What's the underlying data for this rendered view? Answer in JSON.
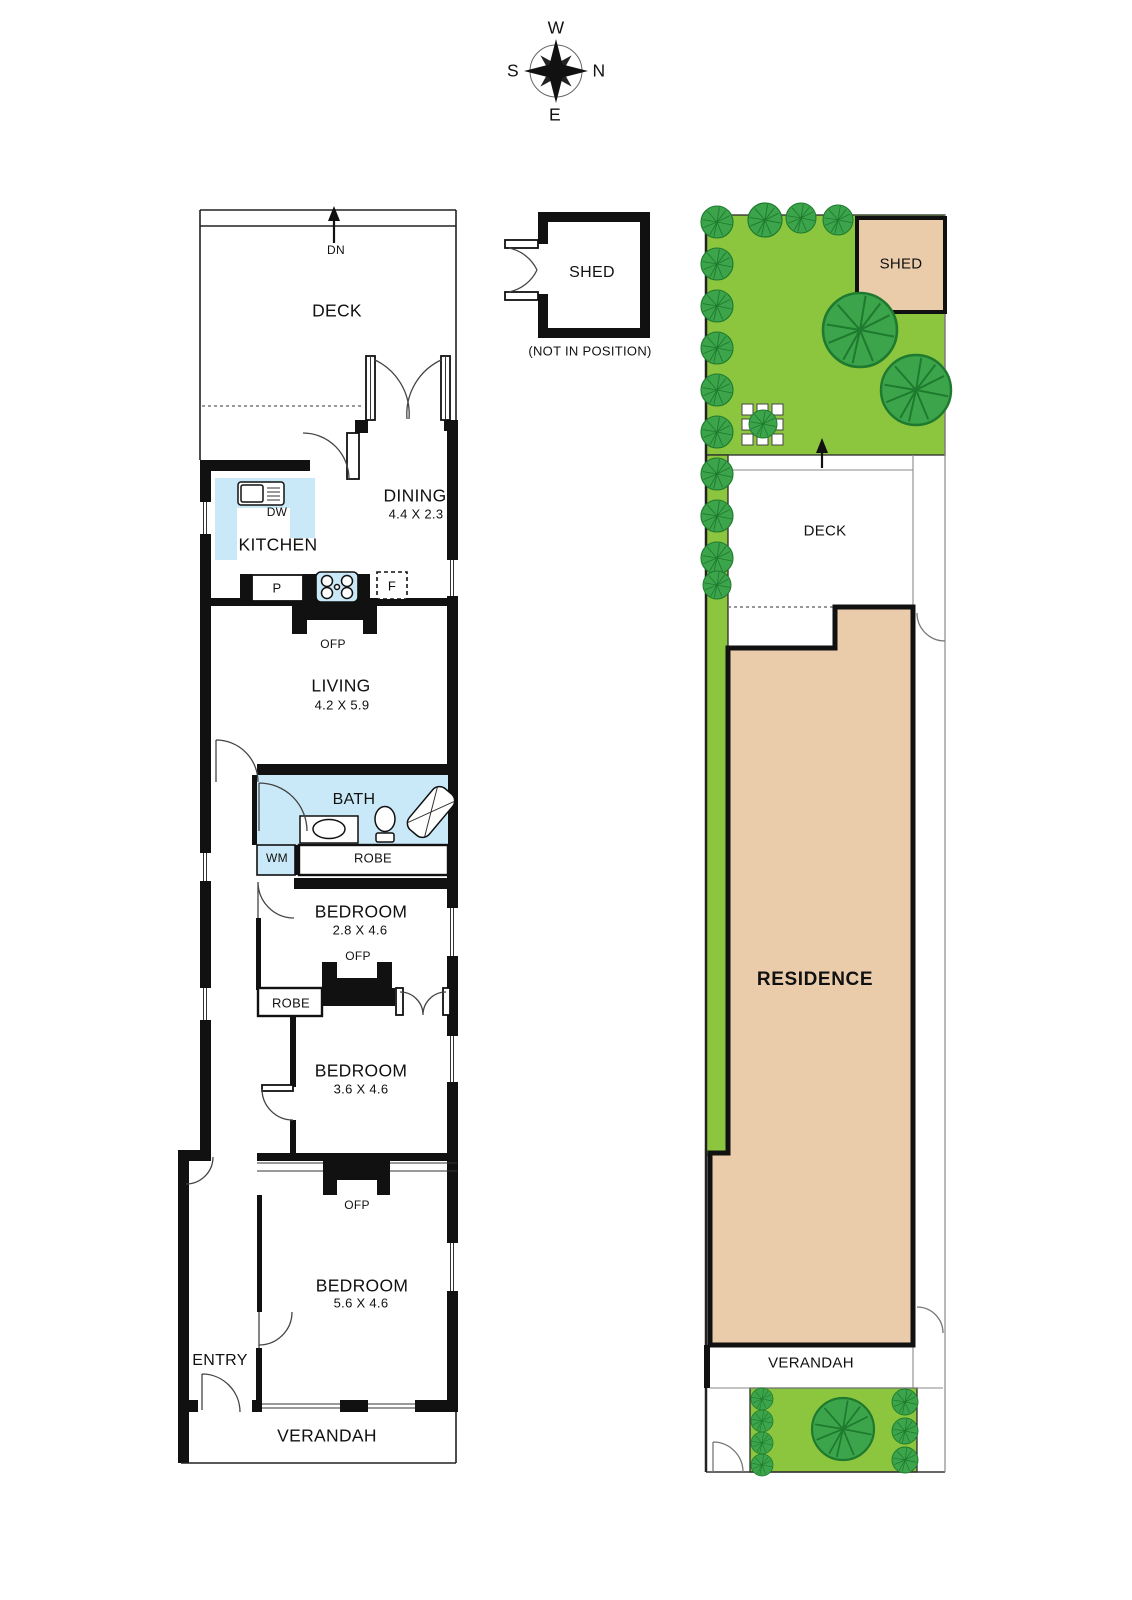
{
  "compass": {
    "west": "W",
    "north": "N",
    "south": "S",
    "east": "E"
  },
  "floorplan": {
    "deck": {
      "label": "DECK",
      "stairs": "DN"
    },
    "dining": {
      "label": "DINING",
      "dims": "4.4 X 2.3"
    },
    "kitchen": {
      "label": "KITCHEN",
      "dishwasher": "DW",
      "pantry": "P",
      "fridge": "F"
    },
    "living": {
      "label": "LIVING",
      "dims": "4.2 X 5.9",
      "fireplace": "OFP"
    },
    "bath": {
      "label": "BATH",
      "washing_machine": "WM",
      "robe": "ROBE"
    },
    "bedroom1": {
      "label": "BEDROOM",
      "dims": "2.8 X 4.6",
      "fireplace": "OFP"
    },
    "bedroom2": {
      "label": "BEDROOM",
      "dims": "3.6 X 4.6",
      "robe": "ROBE"
    },
    "bedroom3": {
      "label": "BEDROOM",
      "dims": "5.6 X 4.6",
      "fireplace": "OFP"
    },
    "entry": {
      "label": "ENTRY"
    },
    "verandah": {
      "label": "VERANDAH"
    }
  },
  "shed": {
    "label": "SHED",
    "note": "(NOT IN POSITION)"
  },
  "siteplan": {
    "shed_label": "SHED",
    "deck_label": "DECK",
    "residence_label": "RESIDENCE",
    "verandah_label": "VERANDAH"
  },
  "colors": {
    "garden_green": "#8CC63E",
    "foliage_green": "#3CA44A",
    "residence_tan": "#EACCAB",
    "fixture_blue": "#C9E9F8",
    "wall_black": "#111111"
  }
}
